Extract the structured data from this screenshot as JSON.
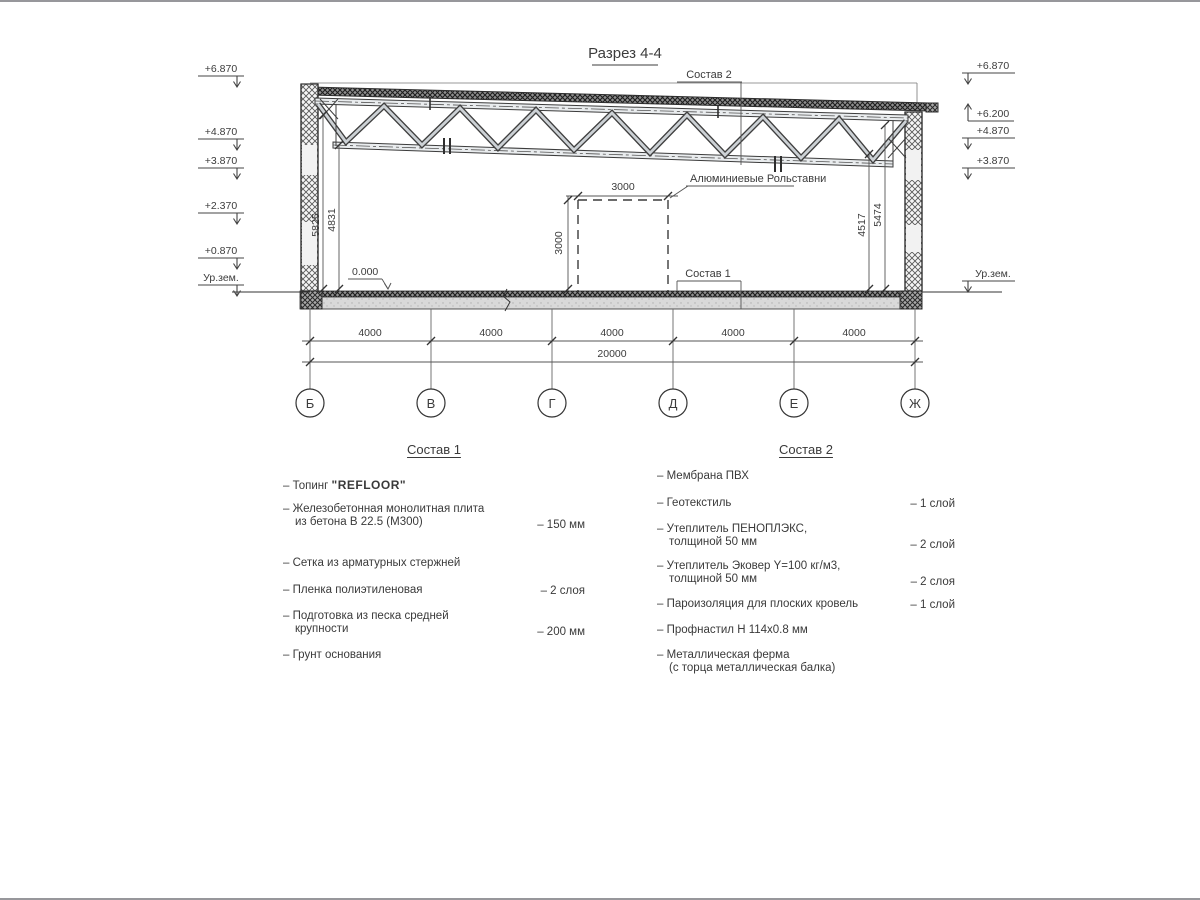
{
  "title": "Разрез 4-4",
  "drawing": {
    "elevations_left": [
      "+6.870",
      "+4.870",
      "+3.870",
      "+2.370",
      "+0.870",
      "Ур.зем."
    ],
    "elevations_right": [
      "+6.870",
      "+6.200",
      "+4.870",
      "+3.870",
      "Ур.зем."
    ],
    "level_zero": "0.000",
    "leader_top": "Состав 2",
    "leader_floor": "Состав 1",
    "leader_door": "Алюминиевые Рольставни",
    "dims": {
      "left_outer": "5825",
      "left_inner": "4831",
      "right_inner": "4517",
      "right_outer": "5474",
      "door_w": "3000",
      "door_h": "3000",
      "total": "20000"
    },
    "spans": [
      "4000",
      "4000",
      "4000",
      "4000",
      "4000"
    ],
    "axes": [
      "Б",
      "В",
      "Г",
      "Д",
      "Е",
      "Ж"
    ]
  },
  "comp1": {
    "title": "Состав 1",
    "items": [
      {
        "line1": "– Топинг ",
        "brand": "\"REFLOOR\"",
        "value": ""
      },
      {
        "line1": "– Железобетонная  монолитная плита",
        "line2": "из бетона В 22.5 (М300)",
        "value": "– 150 мм"
      },
      {
        "line1": "– Сетка из арматурных стержней",
        "value": ""
      },
      {
        "line1": "– Пленка полиэтиленовая",
        "value": "–  2 слоя"
      },
      {
        "line1": "– Подготовка из песка средней",
        "line2": "крупности",
        "value": "– 200 мм"
      },
      {
        "line1": "– Грунт основания",
        "value": ""
      }
    ]
  },
  "comp2": {
    "title": "Состав 2",
    "items": [
      {
        "line1": "– Мембрана ПВХ",
        "value": "– 1 слой"
      },
      {
        "line1": "– Геотекстиль",
        "value": "– 1 слой"
      },
      {
        "line1": "– Утеплитель ПЕНОПЛЭКС,",
        "line2": "толщиной 50 мм",
        "value": "– 2 слой"
      },
      {
        "line1": "– Утеплитель Эковер Y=100 кг/м3,",
        "line2": "толщиной 50 мм",
        "value": "– 2 слоя"
      },
      {
        "line1": "– Пароизоляция для плоских кровель",
        "value": "– 1 слой"
      },
      {
        "line1": "– Профнастил Н 114х0.8 мм",
        "value": ""
      },
      {
        "line1": "– Металлическая ферма",
        "line2": "(с торца металлическая балка)",
        "value": ""
      }
    ]
  }
}
